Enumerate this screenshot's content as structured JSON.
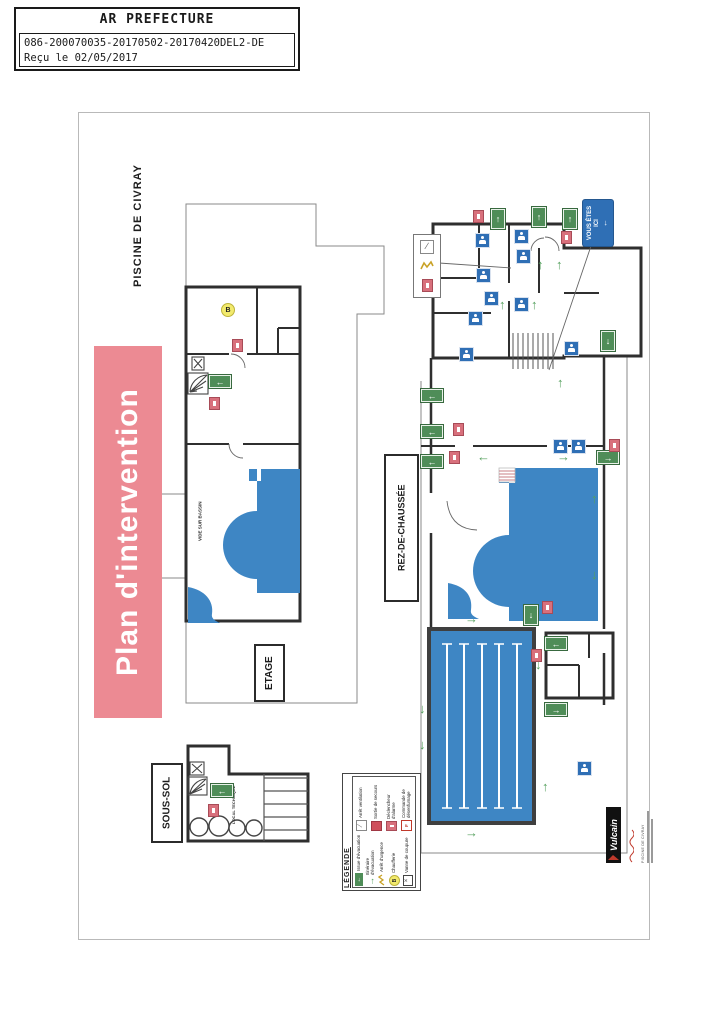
{
  "stamp": {
    "title": "AR PREFECTURE",
    "reference": "086-200070035-20170502-20170420DEL2-DE",
    "received": "Reçu le 02/05/2017"
  },
  "document": {
    "title": "Plan d'intervention",
    "site": "PISCINE DE CIVRAY",
    "floor_labels": {
      "etage": "ETAGE",
      "rez_de_chaussee": "REZ-DE-CHAUSSÉE",
      "sous_sol": "SOUS-SOL"
    },
    "annotations": {
      "vide_sur_bassin": "VIDE SUR BASSIN",
      "local_technique": "LOCAL TECHNIQUE",
      "vous_etes_ici": "VOUS ÊTES ICI",
      "b_marker": "B"
    }
  },
  "legend": {
    "title": "LÉGENDE",
    "left": [
      {
        "icon": "exit-sign",
        "label": "Issue d'évacuation"
      },
      {
        "icon": "green-arrow",
        "label": "Itinéraire d'évacuation"
      },
      {
        "icon": "zigzag",
        "label": "Arrêt d'urgence"
      },
      {
        "icon": "b-circle",
        "label": "Chaufferie"
      },
      {
        "icon": "valve",
        "label": "Vanne de coupure"
      }
    ],
    "right": [
      {
        "icon": "vent",
        "label": "Arrêt ventilation"
      },
      {
        "icon": "red-square",
        "label": "Sortie de secours"
      },
      {
        "icon": "extinguisher",
        "label": "Déclencheur d'alarme"
      },
      {
        "icon": "dif",
        "label": "Commande de désenfumage"
      }
    ]
  },
  "logo": {
    "name": "Vulcain",
    "caption": "PISCINE DE CIVRAY"
  },
  "colors": {
    "pool_blue": "#3E86C4",
    "banner_pink": "#EC8A93",
    "exit_green": "#4F8D58",
    "arrow_green": "#55A05E",
    "extinguisher_red": "#D8707C",
    "picto_blue": "#2F6FB5",
    "marker_yellow": "#F2EA6D"
  }
}
